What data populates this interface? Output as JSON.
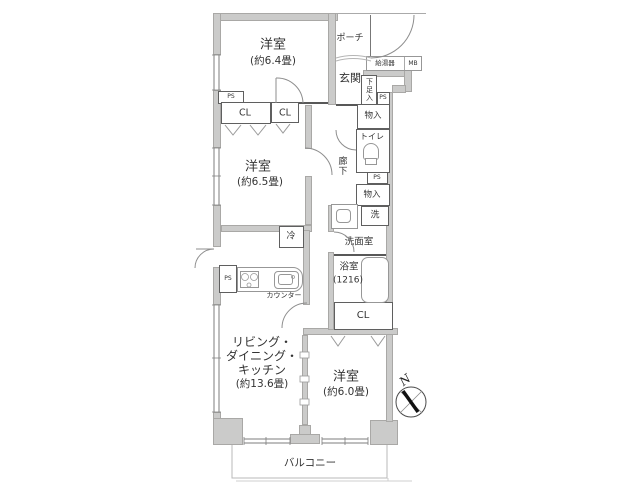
{
  "plan": {
    "rooms": {
      "bedroom1": {
        "name": "洋室",
        "size": "(約6.4畳)"
      },
      "bedroom2": {
        "name": "洋室",
        "size": "(約6.5畳)"
      },
      "bedroom3": {
        "name": "洋室",
        "size": "(約6.0畳)"
      },
      "ldk": {
        "line1": "リビング・",
        "line2": "ダイニング・",
        "line3": "キッチン",
        "size": "(約13.6畳)"
      },
      "bath": {
        "name": "浴室",
        "size": "(1216)"
      },
      "washroom": {
        "name": "洗面室"
      },
      "toilet": {
        "name": "トイレ"
      },
      "entrance": {
        "name": "玄関"
      },
      "porch": {
        "name": "ポーチ"
      },
      "hallway": {
        "name": "廊下"
      },
      "balcony": {
        "name": "バルコニー"
      }
    },
    "fixtures": {
      "closet": "CL",
      "pipe_space": "PS",
      "storage": "物入",
      "shoe_cabinet": "下足入",
      "water_heater": "給湯器",
      "meter_box": "MB",
      "washing_machine": "洗",
      "refrigerator": "冷",
      "counter": "カウンター"
    },
    "compass": {
      "north": "N"
    },
    "colors": {
      "wall": "#cbcbca",
      "line": "#585858",
      "text": "#333333"
    }
  }
}
